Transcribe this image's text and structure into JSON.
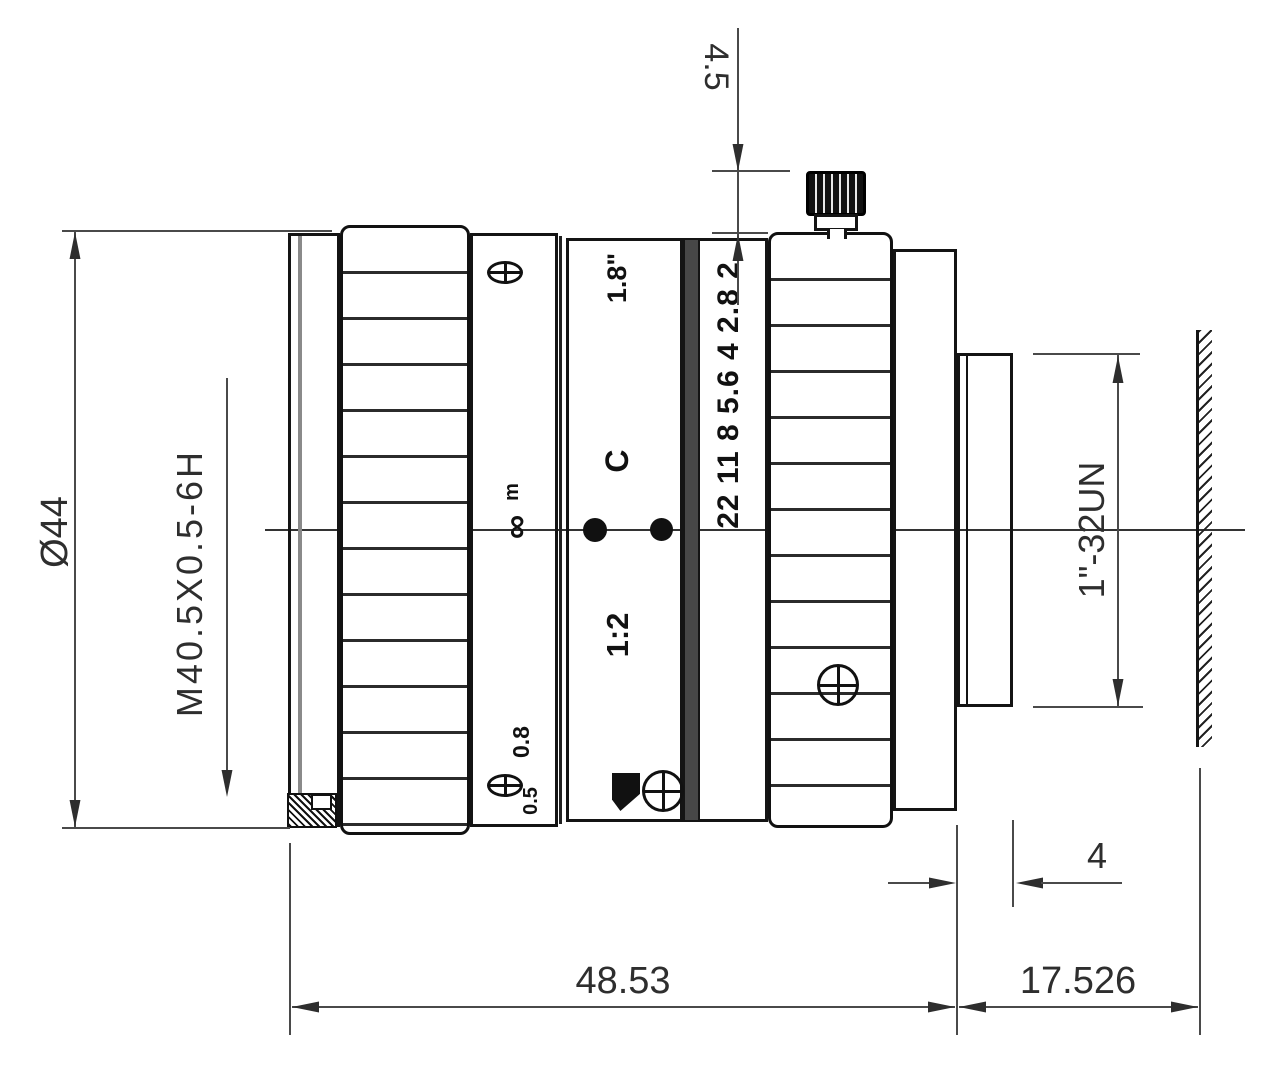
{
  "drawing": {
    "colors": {
      "outline": "#141414",
      "dimension_line": "#4a4a4a",
      "background": "#ffffff"
    },
    "dimensions": {
      "top_clearance": "4.5",
      "front_diameter": "Ø44",
      "filter_thread": "M40.5X0.5-6H",
      "mount_thread": "1\"-32UN",
      "mount_thread_length": "4",
      "barrel_length": "48.53",
      "flange_focal_distance": "17.526"
    },
    "markings": {
      "format": "1.8\"",
      "mount_type": "C",
      "max_aperture": "1:2",
      "aperture_scale": "22 11 8 5.6 4 2.8 2",
      "distance_unit": "m",
      "infinity": "∞",
      "focus_near": "0.8",
      "focus_min": "0.5"
    }
  }
}
